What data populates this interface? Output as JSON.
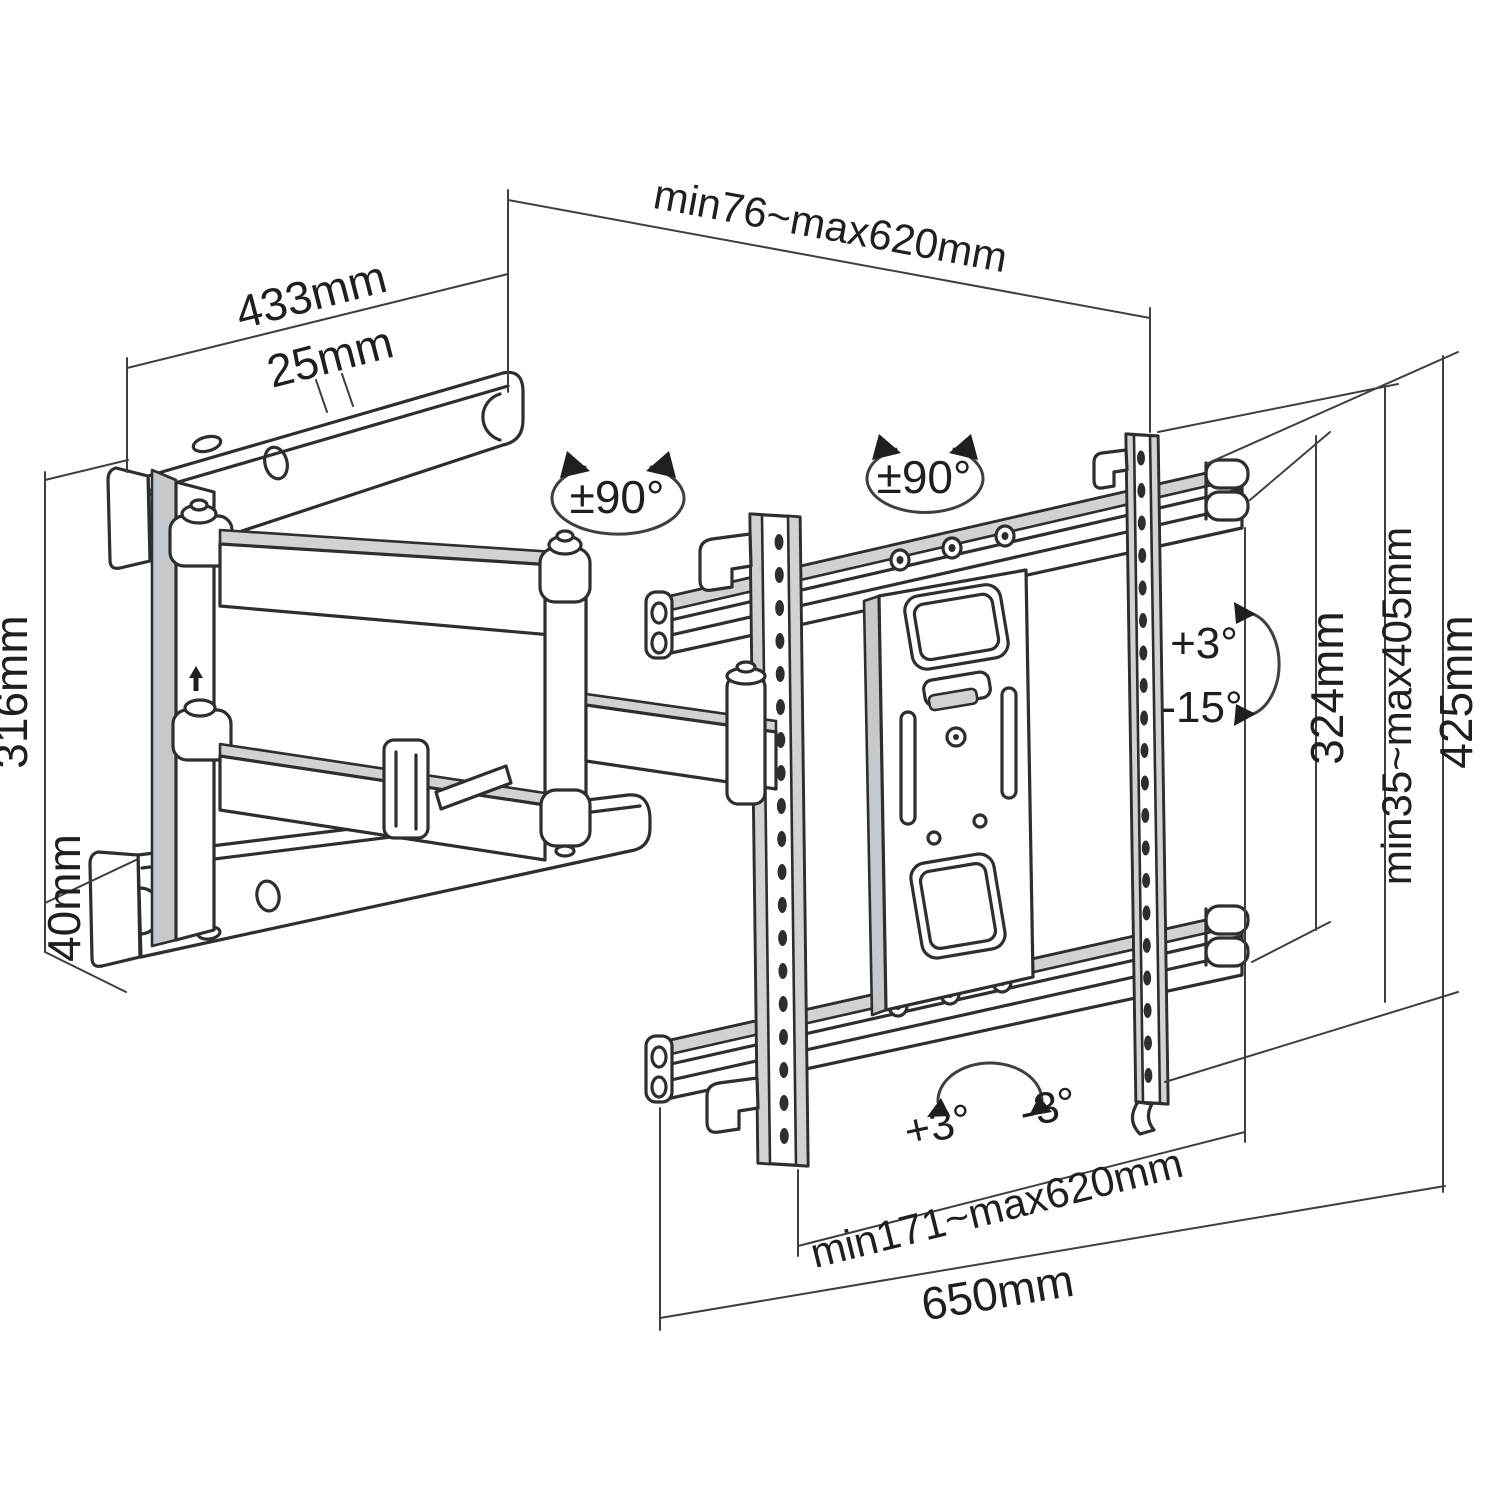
{
  "diagram": {
    "type": "technical-line-drawing",
    "subject": "Articulating full-motion TV wall mount - dimension diagram",
    "colors": {
      "line": "#2e2e2e",
      "dimension_line": "#3f3f3f",
      "text": "#1f1f1f",
      "shading": "#d0d2d4",
      "background": "#ffffff"
    },
    "dimensions": {
      "extension_depth": "min76~max620mm",
      "wall_arm_length": "433mm",
      "arm_top_width": "25mm",
      "wall_plate_height": "316mm",
      "wall_arm_bar_height": "40mm",
      "tv_bracket_width_range": "min171~max620mm",
      "crossbar_length": "650mm",
      "bracket_plate_height": "324mm",
      "rail_height_range": "min35~max405mm",
      "total_bracket_height": "425mm"
    },
    "angles": {
      "swivel_arm": "±90°",
      "swivel_plate": "±90°",
      "tilt_up": "+3°",
      "tilt_down": "-15°",
      "level_plus": "+3°",
      "level_minus": "-3°"
    }
  }
}
